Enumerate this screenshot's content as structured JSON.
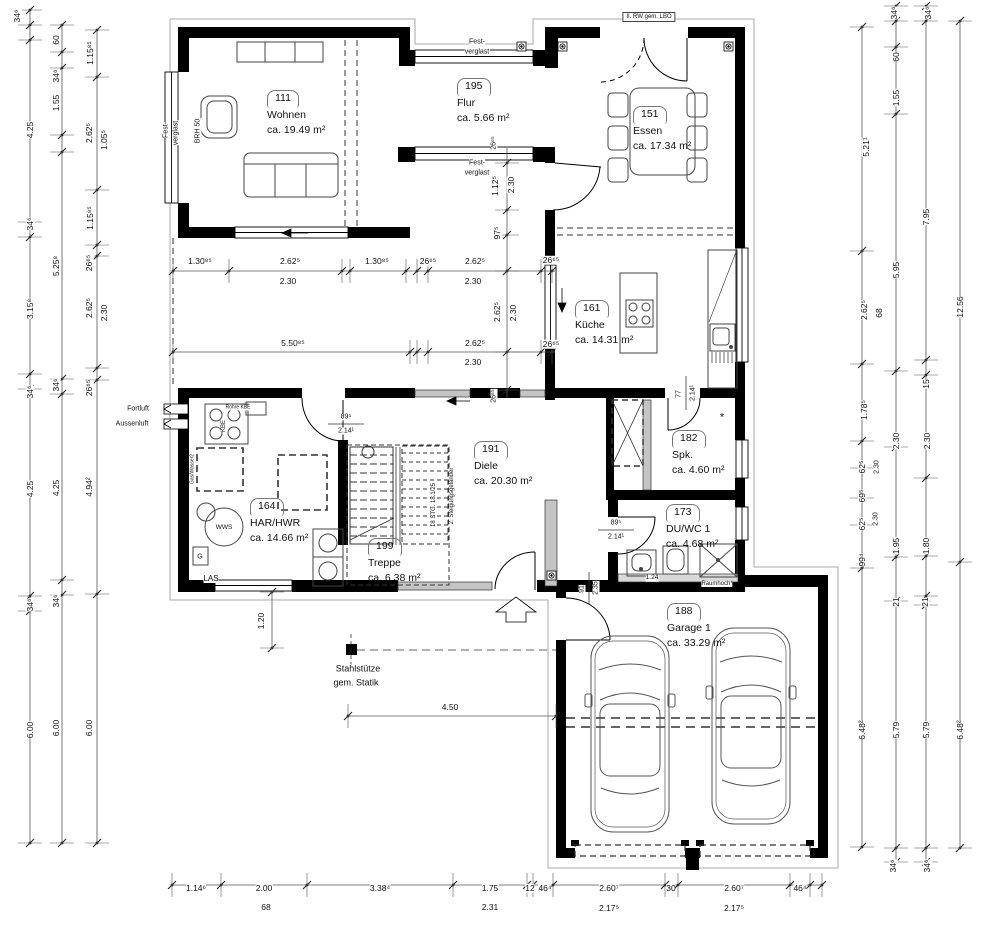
{
  "colors": {
    "wall": "#000000",
    "line": "#444444",
    "dim": "#555555",
    "glazing": "#c4c4c4",
    "paper": "#ffffff"
  },
  "rooms": [
    {
      "number": "111",
      "name": "Wohnen",
      "area": "ca. 19.49 m²"
    },
    {
      "number": "195",
      "name": "Flur",
      "area": "ca. 5.66 m²"
    },
    {
      "number": "151",
      "name": "Essen",
      "area": "ca. 17.34 m²"
    },
    {
      "number": "161",
      "name": "Küche",
      "area": "ca. 14.31 m²"
    },
    {
      "number": "182",
      "name": "Spk.",
      "area": "ca. 4.60 m²"
    },
    {
      "number": "191",
      "name": "Diele",
      "area": "ca. 20.30 m²"
    },
    {
      "number": "164",
      "name": "HAR/HWR",
      "area": "ca. 14.66 m²"
    },
    {
      "number": "199",
      "name": "Treppe",
      "area": "ca. 6.38 m²"
    },
    {
      "number": "173",
      "name": "DU/WC 1",
      "area": "ca. 4.68 m²"
    },
    {
      "number": "188",
      "name": "Garage 1",
      "area": "ca. 33.29 m²"
    }
  ],
  "dims": {
    "labels": [
      {
        "t": "34⁶",
        "x": 17,
        "y": 16,
        "r": true
      },
      {
        "t": "4.25",
        "x": 30,
        "y": 130,
        "r": true
      },
      {
        "t": "34⁶",
        "x": 30,
        "y": 224,
        "r": true
      },
      {
        "t": "3.15⁸",
        "x": 30,
        "y": 309,
        "r": true
      },
      {
        "t": "34⁶",
        "x": 30,
        "y": 392,
        "r": true
      },
      {
        "t": "4.25",
        "x": 30,
        "y": 489,
        "r": true
      },
      {
        "t": "34⁶",
        "x": 30,
        "y": 605,
        "r": true
      },
      {
        "t": "6.00",
        "x": 30,
        "y": 730,
        "r": true
      },
      {
        "t": "60",
        "x": 56,
        "y": 40,
        "r": true
      },
      {
        "t": "34⁶",
        "x": 56,
        "y": 76,
        "r": true
      },
      {
        "t": "1.55",
        "x": 56,
        "y": 103,
        "r": true
      },
      {
        "t": "5.25⁸",
        "x": 56,
        "y": 266,
        "r": true
      },
      {
        "t": "34⁶",
        "x": 56,
        "y": 385,
        "r": true
      },
      {
        "t": "4.25",
        "x": 56,
        "y": 488,
        "r": true
      },
      {
        "t": "34⁶",
        "x": 56,
        "y": 601,
        "r": true
      },
      {
        "t": "6.00",
        "x": 56,
        "y": 728,
        "r": true
      },
      {
        "t": "1.15⁸⁵",
        "x": 90,
        "y": 53,
        "r": true
      },
      {
        "t": "2.62⁵",
        "x": 89,
        "y": 133,
        "r": true
      },
      {
        "t": "1.05⁵",
        "x": 104,
        "y": 140,
        "r": true
      },
      {
        "t": "1.15⁸⁵",
        "x": 90,
        "y": 218,
        "r": true
      },
      {
        "t": "26⁶⁵",
        "x": 89,
        "y": 263,
        "r": true
      },
      {
        "t": "2.62⁵",
        "x": 89,
        "y": 308,
        "r": true
      },
      {
        "t": "2.30",
        "x": 104,
        "y": 313,
        "r": true
      },
      {
        "t": "26⁶⁵",
        "x": 89,
        "y": 388,
        "r": true
      },
      {
        "t": "4.94²",
        "x": 89,
        "y": 487,
        "r": true
      },
      {
        "t": "6.00",
        "x": 89,
        "y": 728,
        "r": true
      },
      {
        "t": "5.21¹",
        "x": 866,
        "y": 147,
        "r": true
      },
      {
        "t": "2.62⁵",
        "x": 864,
        "y": 310,
        "r": true
      },
      {
        "t": "68",
        "x": 879,
        "y": 313,
        "r": true
      },
      {
        "t": "1.78⁵",
        "x": 864,
        "y": 410,
        "r": true
      },
      {
        "t": "62⁵",
        "x": 862,
        "y": 467,
        "r": true
      },
      {
        "t": "2.30",
        "x": 877,
        "y": 467,
        "r": true,
        "s": 7
      },
      {
        "t": "69⁵",
        "x": 862,
        "y": 496,
        "r": true
      },
      {
        "t": "62⁵",
        "x": 862,
        "y": 524,
        "r": true
      },
      {
        "t": "2.30",
        "x": 876,
        "y": 519,
        "r": true,
        "s": 7
      },
      {
        "t": "99⁴",
        "x": 862,
        "y": 560,
        "r": true
      },
      {
        "t": "6.48²",
        "x": 862,
        "y": 730,
        "r": true
      },
      {
        "t": "34⁶",
        "x": 894,
        "y": 13,
        "r": true
      },
      {
        "t": "60",
        "x": 896,
        "y": 57,
        "r": true
      },
      {
        "t": "1.55",
        "x": 896,
        "y": 98,
        "r": true
      },
      {
        "t": "5.95",
        "x": 896,
        "y": 270,
        "r": true
      },
      {
        "t": "2.30",
        "x": 896,
        "y": 441,
        "r": true
      },
      {
        "t": "1.95",
        "x": 896,
        "y": 546,
        "r": true
      },
      {
        "t": "21",
        "x": 896,
        "y": 602,
        "r": true
      },
      {
        "t": "5.79",
        "x": 896,
        "y": 730,
        "r": true
      },
      {
        "t": "34⁶",
        "x": 893,
        "y": 866,
        "r": true
      },
      {
        "t": "34⁶",
        "x": 928,
        "y": 13,
        "r": true
      },
      {
        "t": "7.95",
        "x": 926,
        "y": 217,
        "r": true
      },
      {
        "t": "15",
        "x": 926,
        "y": 384,
        "r": true
      },
      {
        "t": "2.30",
        "x": 927,
        "y": 441,
        "r": true
      },
      {
        "t": "1.80",
        "x": 926,
        "y": 546,
        "r": true
      },
      {
        "t": "21",
        "x": 925,
        "y": 602,
        "r": true
      },
      {
        "t": "5.79",
        "x": 926,
        "y": 730,
        "r": true
      },
      {
        "t": "34⁶",
        "x": 927,
        "y": 866,
        "r": true
      },
      {
        "t": "12.56",
        "x": 960,
        "y": 307,
        "r": true
      },
      {
        "t": "6.48²",
        "x": 960,
        "y": 730,
        "r": true
      },
      {
        "t": "1.14⁶",
        "x": 196,
        "y": 888
      },
      {
        "t": "2.00",
        "x": 264,
        "y": 888
      },
      {
        "t": "68",
        "x": 266,
        "y": 907
      },
      {
        "t": "3.38⁴",
        "x": 380,
        "y": 888
      },
      {
        "t": "1.75",
        "x": 490,
        "y": 888
      },
      {
        "t": "2.31",
        "x": 490,
        "y": 907
      },
      {
        "t": "12",
        "x": 530,
        "y": 888
      },
      {
        "t": "46⁴",
        "x": 545,
        "y": 888
      },
      {
        "t": "2.60⁷",
        "x": 609,
        "y": 888
      },
      {
        "t": "2.17⁵",
        "x": 609,
        "y": 908
      },
      {
        "t": "30",
        "x": 671,
        "y": 888
      },
      {
        "t": "2.60⁷",
        "x": 734,
        "y": 888
      },
      {
        "t": "2.17⁵",
        "x": 734,
        "y": 908
      },
      {
        "t": "46⁴",
        "x": 800,
        "y": 888
      },
      {
        "t": "1.30⁸⁵",
        "x": 200,
        "y": 261
      },
      {
        "t": "2.62⁵",
        "x": 290,
        "y": 261
      },
      {
        "t": "2.30",
        "x": 288,
        "y": 281
      },
      {
        "t": "1.30⁸⁵",
        "x": 377,
        "y": 261
      },
      {
        "t": "26⁶⁵",
        "x": 428,
        "y": 261
      },
      {
        "t": "2.62⁵",
        "x": 475,
        "y": 261
      },
      {
        "t": "2.30",
        "x": 473,
        "y": 281
      },
      {
        "t": "26⁶⁵",
        "x": 551,
        "y": 260
      },
      {
        "t": "5.50⁸⁵",
        "x": 293,
        "y": 343
      },
      {
        "t": "2.62⁵",
        "x": 475,
        "y": 343
      },
      {
        "t": "2.30",
        "x": 473,
        "y": 362
      },
      {
        "t": "26⁶⁵",
        "x": 551,
        "y": 344
      },
      {
        "t": "1.12⁵",
        "x": 495,
        "y": 186,
        "r": true
      },
      {
        "t": "2.30",
        "x": 511,
        "y": 185,
        "r": true
      },
      {
        "t": "97⁵",
        "x": 497,
        "y": 233,
        "r": true
      },
      {
        "t": "26⁶⁵",
        "x": 494,
        "y": 143,
        "r": true,
        "s": 7
      },
      {
        "t": "2.62⁵",
        "x": 497,
        "y": 312,
        "r": true
      },
      {
        "t": "2.30",
        "x": 513,
        "y": 313,
        "r": true
      },
      {
        "t": "26⁶⁵",
        "x": 494,
        "y": 396,
        "r": true,
        "s": 7
      },
      {
        "t": "89⁵",
        "x": 346,
        "y": 417,
        "s": 7
      },
      {
        "t": "2.14¹",
        "x": 346,
        "y": 431,
        "s": 7
      },
      {
        "t": "89⁵",
        "x": 616,
        "y": 523,
        "s": 7
      },
      {
        "t": "2.14¹",
        "x": 616,
        "y": 537,
        "s": 7
      },
      {
        "t": "77",
        "x": 679,
        "y": 394,
        "r": true,
        "s": 7
      },
      {
        "t": "2.14¹",
        "x": 693,
        "y": 393,
        "r": true,
        "s": 7
      },
      {
        "t": "91",
        "x": 582,
        "y": 589,
        "r": true,
        "s": 7
      },
      {
        "t": "2.35",
        "x": 596,
        "y": 588,
        "r": true,
        "s": 7
      },
      {
        "t": "1.20",
        "x": 261,
        "y": 621,
        "r": true
      },
      {
        "t": "4.50",
        "x": 450,
        "y": 707
      },
      {
        "t": "1.24",
        "x": 652,
        "y": 578,
        "s": 6.5
      }
    ]
  },
  "annotations": [
    {
      "t": "II. RW gem. LBO",
      "x": 649,
      "y": 17,
      "s": 6,
      "box": true
    },
    {
      "t": "Fest-",
      "x": 477,
      "y": 42,
      "s": 7
    },
    {
      "t": "verglast",
      "x": 477,
      "y": 52,
      "s": 7
    },
    {
      "t": "Fest-",
      "x": 477,
      "y": 163,
      "s": 7
    },
    {
      "t": "verglast",
      "x": 477,
      "y": 173,
      "s": 7
    },
    {
      "t": "Fest-",
      "x": 166,
      "y": 130,
      "s": 7,
      "r": true
    },
    {
      "t": "verglast",
      "x": 176,
      "y": 133,
      "s": 7,
      "r": true
    },
    {
      "t": "BRH 50",
      "x": 198,
      "y": 131,
      "s": 7,
      "r": true
    },
    {
      "t": "Fortluft",
      "x": 138,
      "y": 409,
      "s": 7
    },
    {
      "t": "Aussenluft",
      "x": 132,
      "y": 424,
      "s": 7
    },
    {
      "t": "Rohre KBE",
      "x": 238,
      "y": 408,
      "s": 5
    },
    {
      "t": "KBE",
      "x": 224,
      "y": 426,
      "s": 6,
      "r": true
    },
    {
      "t": "Gas/Wasser2",
      "x": 193,
      "y": 469,
      "s": 5,
      "r": true
    },
    {
      "t": "WWS",
      "x": 224,
      "y": 528,
      "s": 6.5
    },
    {
      "t": "G",
      "x": 200,
      "y": 557,
      "s": 7
    },
    {
      "t": "LAS",
      "x": 211,
      "y": 579,
      "s": 8
    },
    {
      "t": "18 STG. 18.1/25",
      "x": 434,
      "y": 505,
      "s": 6,
      "r": true
    },
    {
      "t": "2. Steigungsgeländer",
      "x": 452,
      "y": 496,
      "s": 6,
      "r": true
    },
    {
      "t": "Stahlstütze",
      "x": 358,
      "y": 669,
      "s": 9
    },
    {
      "t": "gem. Statik",
      "x": 356,
      "y": 683,
      "s": 9
    },
    {
      "t": "Raumhoch*",
      "x": 717,
      "y": 584,
      "s": 6
    },
    {
      "t": "*",
      "x": 722,
      "y": 418,
      "s": 11
    }
  ]
}
